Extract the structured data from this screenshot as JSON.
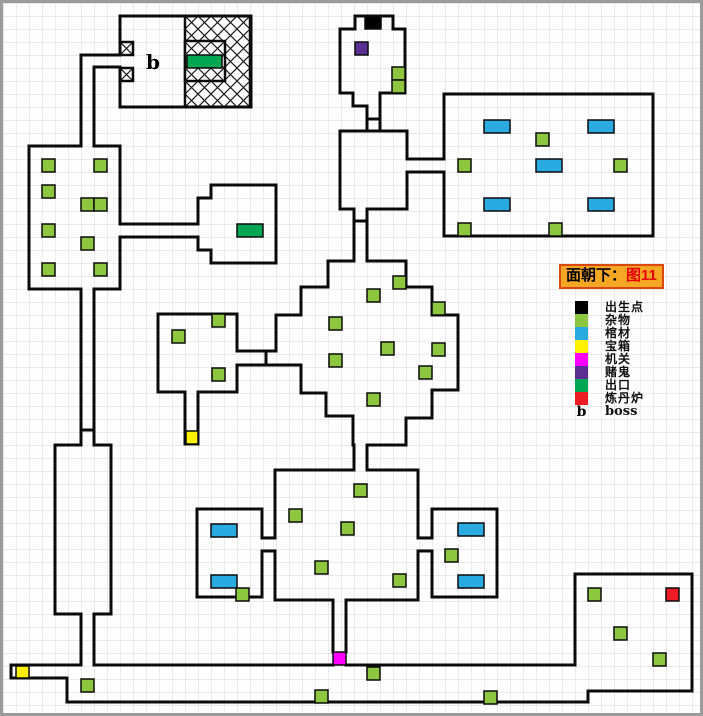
{
  "legend": {
    "title": {
      "prefix": "面朝下：",
      "highlight": "图11"
    },
    "items": [
      {
        "key": "spawn",
        "label": "出生点",
        "color": "#000000"
      },
      {
        "key": "junk",
        "label": "杂物",
        "color": "#8dc63f"
      },
      {
        "key": "coffin",
        "label": "棺材",
        "color": "#29abe2"
      },
      {
        "key": "chest",
        "label": "宝箱",
        "color": "#fff200"
      },
      {
        "key": "trap",
        "label": "机关",
        "color": "#ff00ff"
      },
      {
        "key": "gambler",
        "label": "赌鬼",
        "color": "#5b2e91"
      },
      {
        "key": "exit",
        "label": "出口",
        "color": "#00a651"
      },
      {
        "key": "furnace",
        "label": "炼丹炉",
        "color": "#ed1c24"
      },
      {
        "key": "boss",
        "label": "boss",
        "swatch_text": "b"
      }
    ]
  },
  "map": {
    "size": {
      "w": 703,
      "h": 716
    },
    "colors": {
      "spawn": "#000000",
      "junk": "#8dc63f",
      "coffin": "#29abe2",
      "chest": "#fff200",
      "trap": "#ff00ff",
      "gambler": "#5b2e91",
      "exit": "#00a651",
      "furnace": "#ed1c24"
    },
    "walls": [
      [
        [
          117,
          52
        ],
        [
          117,
          13
        ],
        [
          248,
          13
        ],
        [
          248,
          104
        ],
        [
          117,
          104
        ],
        [
          117,
          64
        ]
      ],
      [
        [
          117,
          52
        ],
        [
          78,
          52
        ],
        [
          78,
          143
        ]
      ],
      [
        [
          117,
          64
        ],
        [
          91,
          64
        ],
        [
          91,
          143
        ]
      ],
      [
        [
          91,
          143
        ],
        [
          117,
          143
        ],
        [
          117,
          221
        ]
      ],
      [
        [
          117,
          234
        ],
        [
          117,
          286
        ],
        [
          91,
          286
        ]
      ],
      [
        [
          78,
          286
        ],
        [
          26,
          286
        ],
        [
          26,
          143
        ],
        [
          78,
          143
        ]
      ],
      [
        [
          117,
          221
        ],
        [
          195,
          221
        ]
      ],
      [
        [
          117,
          234
        ],
        [
          195,
          234
        ]
      ],
      [
        [
          195,
          221
        ],
        [
          195,
          195
        ],
        [
          208,
          195
        ],
        [
          208,
          182
        ],
        [
          273,
          182
        ],
        [
          273,
          260
        ],
        [
          208,
          260
        ],
        [
          208,
          247
        ],
        [
          195,
          247
        ],
        [
          195,
          234
        ]
      ],
      [
        [
          78,
          286
        ],
        [
          78,
          427
        ]
      ],
      [
        [
          91,
          286
        ],
        [
          91,
          427
        ]
      ],
      [
        [
          78,
          427
        ],
        [
          91,
          427
        ]
      ],
      [
        [
          78,
          427
        ],
        [
          78,
          442
        ],
        [
          52,
          442
        ],
        [
          52,
          611
        ],
        [
          78,
          611
        ]
      ],
      [
        [
          91,
          427
        ],
        [
          91,
          442
        ],
        [
          108,
          442
        ],
        [
          108,
          611
        ],
        [
          91,
          611
        ]
      ],
      [
        [
          78,
          611
        ],
        [
          78,
          662
        ]
      ],
      [
        [
          91,
          611
        ],
        [
          91,
          662
        ]
      ],
      [
        [
          91,
          662
        ],
        [
          330,
          662
        ]
      ],
      [
        [
          343,
          662
        ],
        [
          572,
          662
        ],
        [
          572,
          571
        ],
        [
          689,
          571
        ],
        [
          689,
          688
        ],
        [
          585,
          688
        ],
        [
          585,
          699
        ],
        [
          64,
          699
        ],
        [
          64,
          675
        ],
        [
          8,
          675
        ],
        [
          8,
          662
        ],
        [
          78,
          662
        ]
      ],
      [
        [
          352,
          26
        ],
        [
          352,
          13
        ],
        [
          390,
          13
        ],
        [
          390,
          26
        ],
        [
          402,
          26
        ],
        [
          402,
          90
        ],
        [
          377,
          90
        ],
        [
          377,
          128
        ]
      ],
      [
        [
          352,
          26
        ],
        [
          337,
          26
        ],
        [
          337,
          90
        ],
        [
          350,
          90
        ],
        [
          350,
          103
        ],
        [
          364,
          103
        ],
        [
          364,
          128
        ]
      ],
      [
        [
          364,
          116
        ],
        [
          377,
          116
        ]
      ],
      [
        [
          351,
          206
        ],
        [
          337,
          206
        ],
        [
          337,
          128
        ],
        [
          404,
          128
        ],
        [
          404,
          156
        ]
      ],
      [
        [
          404,
          169
        ],
        [
          404,
          206
        ],
        [
          364,
          206
        ]
      ],
      [
        [
          404,
          156
        ],
        [
          441,
          156
        ]
      ],
      [
        [
          404,
          169
        ],
        [
          441,
          169
        ]
      ],
      [
        [
          441,
          156
        ],
        [
          441,
          91
        ],
        [
          650,
          91
        ],
        [
          650,
          233
        ],
        [
          441,
          233
        ],
        [
          441,
          169
        ]
      ],
      [
        [
          351,
          206
        ],
        [
          351,
          258
        ]
      ],
      [
        [
          364,
          206
        ],
        [
          364,
          258
        ]
      ],
      [
        [
          351,
          218
        ],
        [
          364,
          218
        ]
      ],
      [
        [
          351,
          258
        ],
        [
          325,
          258
        ],
        [
          325,
          284
        ],
        [
          298,
          284
        ],
        [
          298,
          312
        ],
        [
          273,
          312
        ],
        [
          273,
          348
        ]
      ],
      [
        [
          273,
          362
        ],
        [
          298,
          362
        ],
        [
          298,
          390
        ],
        [
          323,
          390
        ],
        [
          323,
          413
        ],
        [
          350,
          413
        ],
        [
          350,
          442
        ],
        [
          351,
          442
        ],
        [
          351,
          467
        ]
      ],
      [
        [
          364,
          258
        ],
        [
          403,
          258
        ],
        [
          403,
          284
        ],
        [
          429,
          284
        ],
        [
          429,
          312
        ],
        [
          455,
          312
        ],
        [
          455,
          387
        ],
        [
          429,
          387
        ],
        [
          429,
          415
        ],
        [
          403,
          415
        ],
        [
          403,
          442
        ],
        [
          364,
          442
        ],
        [
          364,
          467
        ]
      ],
      [
        [
          234,
          348
        ],
        [
          273,
          348
        ]
      ],
      [
        [
          234,
          362
        ],
        [
          273,
          362
        ]
      ],
      [
        [
          263,
          348
        ],
        [
          263,
          362
        ]
      ],
      [
        [
          234,
          348
        ],
        [
          234,
          311
        ],
        [
          155,
          311
        ],
        [
          155,
          389
        ],
        [
          182,
          389
        ]
      ],
      [
        [
          195,
          389
        ],
        [
          234,
          389
        ],
        [
          234,
          362
        ]
      ],
      [
        [
          182,
          389
        ],
        [
          182,
          441
        ],
        [
          195,
          441
        ],
        [
          195,
          389
        ]
      ],
      [
        [
          351,
          467
        ],
        [
          272,
          467
        ],
        [
          272,
          535
        ]
      ],
      [
        [
          272,
          548
        ],
        [
          272,
          597
        ],
        [
          330,
          597
        ]
      ],
      [
        [
          343,
          597
        ],
        [
          415,
          597
        ],
        [
          415,
          548
        ]
      ],
      [
        [
          415,
          535
        ],
        [
          415,
          467
        ],
        [
          364,
          467
        ]
      ],
      [
        [
          259,
          535
        ],
        [
          272,
          535
        ]
      ],
      [
        [
          259,
          548
        ],
        [
          272,
          548
        ]
      ],
      [
        [
          259,
          535
        ],
        [
          259,
          506
        ],
        [
          194,
          506
        ],
        [
          194,
          594
        ],
        [
          259,
          594
        ],
        [
          259,
          548
        ]
      ],
      [
        [
          415,
          535
        ],
        [
          429,
          535
        ]
      ],
      [
        [
          415,
          548
        ],
        [
          429,
          548
        ]
      ],
      [
        [
          429,
          535
        ],
        [
          429,
          506
        ],
        [
          494,
          506
        ],
        [
          494,
          594
        ],
        [
          429,
          594
        ],
        [
          429,
          548
        ]
      ],
      [
        [
          330,
          597
        ],
        [
          330,
          649
        ]
      ],
      [
        [
          343,
          597
        ],
        [
          343,
          649
        ]
      ]
    ],
    "hatch_areas": [
      {
        "x": 182,
        "y": 13,
        "w": 65,
        "h": 91
      },
      {
        "x": 182,
        "y": 38,
        "w": 40,
        "h": 40
      },
      {
        "x": 117,
        "y": 39,
        "w": 13,
        "h": 13
      },
      {
        "x": 117,
        "y": 65,
        "w": 13,
        "h": 13
      }
    ],
    "markers": [
      {
        "t": "spawn",
        "x": 362,
        "y": 13,
        "w": 16,
        "h": 13
      },
      {
        "t": "gambler",
        "x": 352,
        "y": 39,
        "w": 13,
        "h": 13
      },
      {
        "t": "exit",
        "x": 184,
        "y": 52,
        "w": 35,
        "h": 13
      },
      {
        "t": "exit",
        "x": 234,
        "y": 221,
        "w": 26,
        "h": 13
      },
      {
        "t": "chest",
        "x": 183,
        "y": 428,
        "w": 12,
        "h": 13
      },
      {
        "t": "chest",
        "x": 13,
        "y": 663,
        "w": 13,
        "h": 12
      },
      {
        "t": "trap",
        "x": 330,
        "y": 649,
        "w": 13,
        "h": 13
      },
      {
        "t": "furnace",
        "x": 663,
        "y": 585,
        "w": 13,
        "h": 13
      },
      {
        "t": "coffin",
        "x": 481,
        "y": 117,
        "w": 26,
        "h": 13
      },
      {
        "t": "coffin",
        "x": 585,
        "y": 117,
        "w": 26,
        "h": 13
      },
      {
        "t": "coffin",
        "x": 533,
        "y": 156,
        "w": 26,
        "h": 13
      },
      {
        "t": "coffin",
        "x": 481,
        "y": 195,
        "w": 26,
        "h": 13
      },
      {
        "t": "coffin",
        "x": 585,
        "y": 195,
        "w": 26,
        "h": 13
      },
      {
        "t": "coffin",
        "x": 208,
        "y": 521,
        "w": 26,
        "h": 13
      },
      {
        "t": "coffin",
        "x": 208,
        "y": 572,
        "w": 26,
        "h": 13
      },
      {
        "t": "coffin",
        "x": 455,
        "y": 520,
        "w": 26,
        "h": 13
      },
      {
        "t": "coffin",
        "x": 455,
        "y": 572,
        "w": 26,
        "h": 13
      },
      {
        "t": "junk",
        "x": 389,
        "y": 64,
        "w": 13,
        "h": 13
      },
      {
        "t": "junk",
        "x": 389,
        "y": 77,
        "w": 13,
        "h": 13
      },
      {
        "t": "junk",
        "x": 533,
        "y": 130,
        "w": 13,
        "h": 13
      },
      {
        "t": "junk",
        "x": 455,
        "y": 156,
        "w": 13,
        "h": 13
      },
      {
        "t": "junk",
        "x": 611,
        "y": 156,
        "w": 13,
        "h": 13
      },
      {
        "t": "junk",
        "x": 455,
        "y": 220,
        "w": 13,
        "h": 13
      },
      {
        "t": "junk",
        "x": 546,
        "y": 220,
        "w": 13,
        "h": 13
      },
      {
        "t": "junk",
        "x": 39,
        "y": 156,
        "w": 13,
        "h": 13
      },
      {
        "t": "junk",
        "x": 91,
        "y": 156,
        "w": 13,
        "h": 13
      },
      {
        "t": "junk",
        "x": 39,
        "y": 182,
        "w": 13,
        "h": 13
      },
      {
        "t": "junk",
        "x": 78,
        "y": 195,
        "w": 13,
        "h": 13
      },
      {
        "t": "junk",
        "x": 91,
        "y": 195,
        "w": 13,
        "h": 13
      },
      {
        "t": "junk",
        "x": 39,
        "y": 221,
        "w": 13,
        "h": 13
      },
      {
        "t": "junk",
        "x": 78,
        "y": 234,
        "w": 13,
        "h": 13
      },
      {
        "t": "junk",
        "x": 39,
        "y": 260,
        "w": 13,
        "h": 13
      },
      {
        "t": "junk",
        "x": 91,
        "y": 260,
        "w": 13,
        "h": 13
      },
      {
        "t": "junk",
        "x": 209,
        "y": 311,
        "w": 13,
        "h": 13
      },
      {
        "t": "junk",
        "x": 169,
        "y": 327,
        "w": 13,
        "h": 13
      },
      {
        "t": "junk",
        "x": 209,
        "y": 365,
        "w": 13,
        "h": 13
      },
      {
        "t": "junk",
        "x": 390,
        "y": 273,
        "w": 13,
        "h": 13
      },
      {
        "t": "junk",
        "x": 364,
        "y": 286,
        "w": 13,
        "h": 13
      },
      {
        "t": "junk",
        "x": 326,
        "y": 314,
        "w": 13,
        "h": 13
      },
      {
        "t": "junk",
        "x": 429,
        "y": 299,
        "w": 13,
        "h": 13
      },
      {
        "t": "junk",
        "x": 429,
        "y": 340,
        "w": 13,
        "h": 13
      },
      {
        "t": "junk",
        "x": 416,
        "y": 363,
        "w": 13,
        "h": 13
      },
      {
        "t": "junk",
        "x": 378,
        "y": 339,
        "w": 13,
        "h": 13
      },
      {
        "t": "junk",
        "x": 326,
        "y": 351,
        "w": 13,
        "h": 13
      },
      {
        "t": "junk",
        "x": 364,
        "y": 390,
        "w": 13,
        "h": 13
      },
      {
        "t": "junk",
        "x": 351,
        "y": 481,
        "w": 13,
        "h": 13
      },
      {
        "t": "junk",
        "x": 286,
        "y": 506,
        "w": 13,
        "h": 13
      },
      {
        "t": "junk",
        "x": 338,
        "y": 519,
        "w": 13,
        "h": 13
      },
      {
        "t": "junk",
        "x": 312,
        "y": 558,
        "w": 13,
        "h": 13
      },
      {
        "t": "junk",
        "x": 390,
        "y": 571,
        "w": 13,
        "h": 13
      },
      {
        "t": "junk",
        "x": 233,
        "y": 585,
        "w": 13,
        "h": 13
      },
      {
        "t": "junk",
        "x": 442,
        "y": 546,
        "w": 13,
        "h": 13
      },
      {
        "t": "junk",
        "x": 585,
        "y": 585,
        "w": 13,
        "h": 13
      },
      {
        "t": "junk",
        "x": 611,
        "y": 624,
        "w": 13,
        "h": 13
      },
      {
        "t": "junk",
        "x": 650,
        "y": 650,
        "w": 13,
        "h": 13
      },
      {
        "t": "junk",
        "x": 78,
        "y": 676,
        "w": 13,
        "h": 13
      },
      {
        "t": "junk",
        "x": 364,
        "y": 664,
        "w": 13,
        "h": 13
      },
      {
        "t": "junk",
        "x": 312,
        "y": 687,
        "w": 13,
        "h": 13
      },
      {
        "t": "junk",
        "x": 481,
        "y": 688,
        "w": 13,
        "h": 13
      }
    ],
    "labels": [
      {
        "text": "b",
        "x": 150,
        "y": 66
      }
    ]
  }
}
